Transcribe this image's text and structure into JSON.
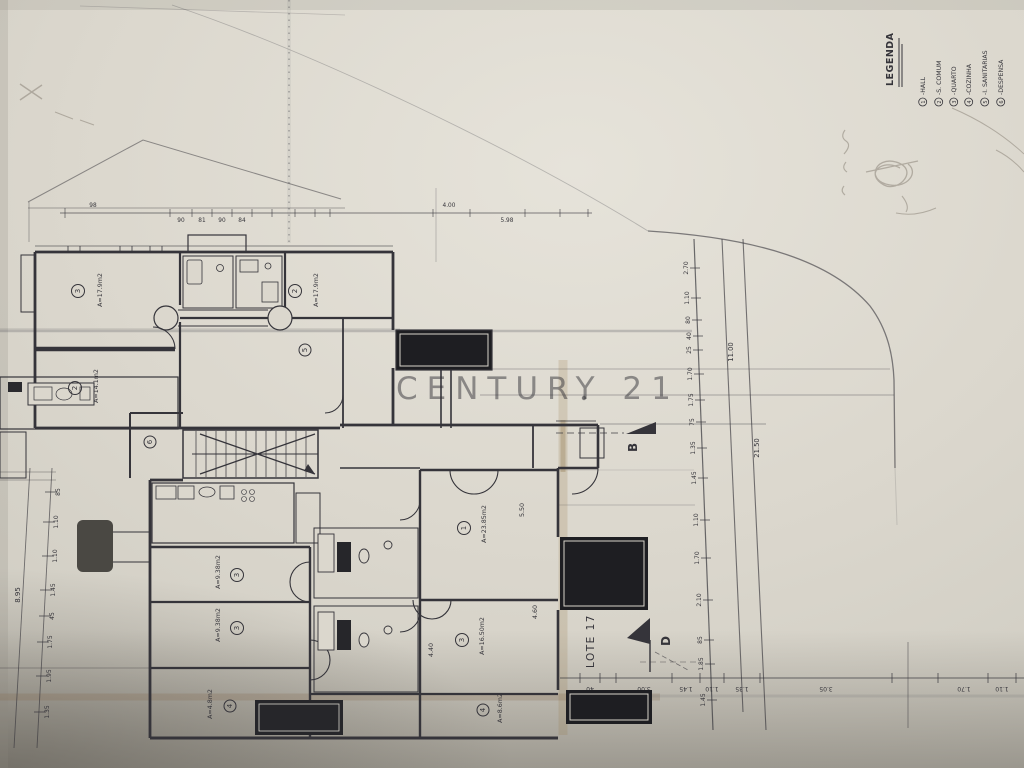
{
  "watermark": {
    "text": "CENTURY 21",
    "color": "#c59e5e"
  },
  "legend": {
    "title": "LEGENDA",
    "items": [
      {
        "num": "1",
        "label": "-HALL"
      },
      {
        "num": "2",
        "label": "-S. COMUM"
      },
      {
        "num": "3",
        "label": "-QUARTO"
      },
      {
        "num": "4",
        "label": "-COZINHA"
      },
      {
        "num": "5",
        "label": "-I. SANITARIAS"
      },
      {
        "num": "6",
        "label": "-DESPENSA"
      }
    ]
  },
  "site": {
    "lot_label": "LOTE 17",
    "section_b": "B",
    "section_d": "D"
  },
  "rooms": [
    {
      "num": "3",
      "area": "A=17.9m2"
    },
    {
      "num": "2",
      "area": "A=14.1m2"
    },
    {
      "num": "2",
      "area": "A=17.9m2"
    },
    {
      "num": "6",
      "area": ""
    },
    {
      "num": "1",
      "area": "A=23.85m2"
    },
    {
      "num": "3",
      "area": "A=16.50m2"
    },
    {
      "num": "3",
      "area": "A=9.38m2"
    },
    {
      "num": "3",
      "area": "A=9.38m2"
    },
    {
      "num": "4",
      "area": "A=8.6m2"
    },
    {
      "num": "4",
      "area": "A=4.8m2"
    },
    {
      "num": "5",
      "area": ""
    }
  ],
  "dims": {
    "right_chain": [
      "2.70",
      "1.10",
      "80",
      "40",
      "25",
      "1.70",
      "1.75",
      "75",
      "1.35",
      "1.45",
      "1.10",
      "1.70",
      "2.10",
      "85",
      "1.85",
      "1.45"
    ],
    "road_labels": [
      "11.00",
      "21.50"
    ],
    "left_chain": [
      "85",
      "1.10",
      "1.10",
      "1.45",
      "45",
      "1.75",
      "1.95",
      "1.35"
    ],
    "left_total": "8.95",
    "bottom_chain": [
      "40",
      "3.00",
      "1.45",
      "1.10",
      "1.35",
      "3.05",
      "1.70",
      "1.10"
    ],
    "top_chain": [
      "98",
      "90",
      "81",
      "90",
      "84",
      "4.00",
      "5.98"
    ],
    "room_dims": [
      "5.50",
      "4.60",
      "4.40"
    ]
  }
}
